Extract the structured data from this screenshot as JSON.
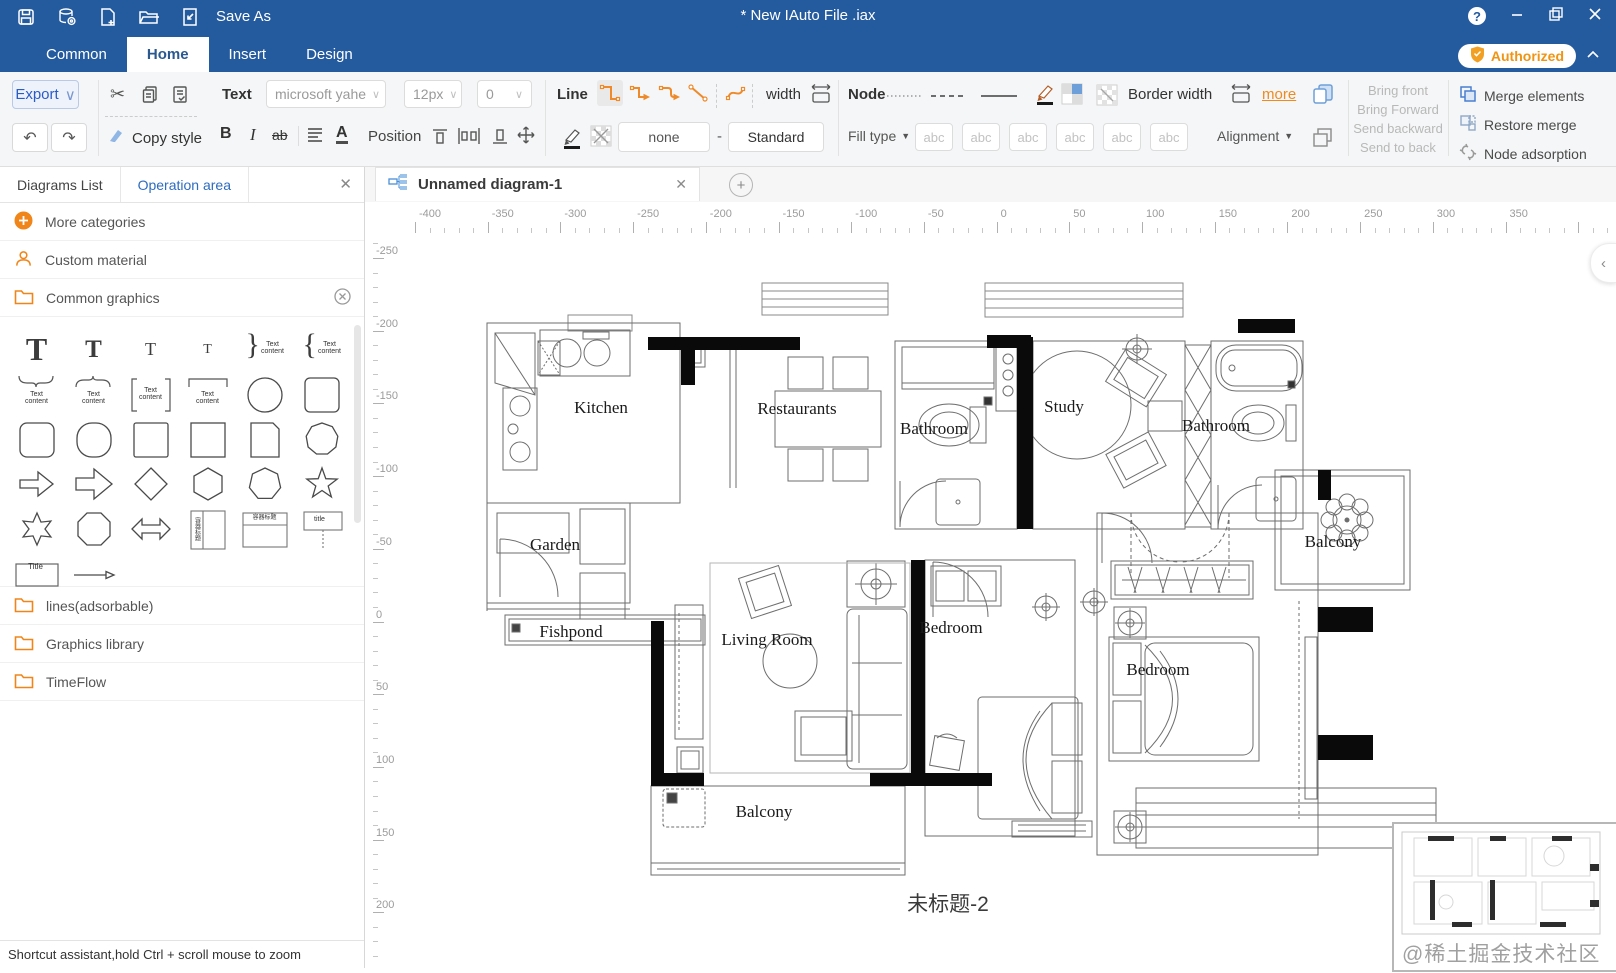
{
  "titlebar": {
    "save_as": "Save As",
    "title": "* New IAuto File .iax",
    "help": "?",
    "authorized": "Authorized"
  },
  "menu": {
    "items": [
      "Common",
      "Home",
      "Insert",
      "Design"
    ],
    "active": "Home"
  },
  "toolbar": {
    "export": "Export",
    "text_label": "Text",
    "font_family": "microsoft yahe",
    "font_size": "12px",
    "char_spacing": "0",
    "copy_style": "Copy style",
    "bold": "B",
    "italic": "I",
    "strikethrough": "ab",
    "font_color": "A",
    "position_label": "Position",
    "line_label": "Line",
    "width_label": "width",
    "line_fill_value": "none",
    "dash": "-",
    "line_style_value": "Standard",
    "node_label": "Node",
    "fill_type_label": "Fill type",
    "abc_sample": "abc",
    "border_width_label": "Border width",
    "more_link": "more",
    "alignment_label": "Alignment",
    "bring_front": "Bring front",
    "bring_forward": "Bring Forward",
    "send_backward": "Send backward",
    "send_to_back": "Send to back",
    "merge_elements": "Merge elements",
    "restore_merge": "Restore merge",
    "node_adsorption": "Node adsorption"
  },
  "sidebar": {
    "tab_diagrams": "Diagrams List",
    "tab_operation": "Operation area",
    "more_categories": "More categories",
    "custom_material": "Custom material",
    "common_graphics": "Common graphics",
    "lines_adsorbable": "lines(adsorbable)",
    "graphics_library": "Graphics library",
    "timeflow": "TimeFlow",
    "palette": {
      "text_content": "Text content",
      "container_title": "容器标题",
      "callout_title": "title",
      "title": "Title"
    },
    "footer": "Shortcut assistant,hold Ctrl + scroll mouse to zoom"
  },
  "canvas": {
    "doc_tab": "Unnamed diagram-1",
    "diagram_title": "未标题-2",
    "watermark": "@稀土掘金技术社区",
    "h_ruler": [
      -400,
      -350,
      -300,
      -250,
      -200,
      -150,
      -100,
      -50,
      0,
      50,
      100,
      150,
      200,
      250,
      300,
      350
    ],
    "v_ruler": [
      -250,
      -200,
      -150,
      -100,
      -50,
      0,
      50,
      100,
      150,
      200
    ]
  },
  "floorplan": {
    "rooms": [
      {
        "label": "Kitchen"
      },
      {
        "label": "Restaurants"
      },
      {
        "label": "Bathroom"
      },
      {
        "label": "Study"
      },
      {
        "label": "Bathroom"
      },
      {
        "label": "Garden"
      },
      {
        "label": "Fishpond"
      },
      {
        "label": "Living Room"
      },
      {
        "label": "Bedroom"
      },
      {
        "label": "Bedroom"
      },
      {
        "label": "Balcony"
      },
      {
        "label": "Balcony"
      }
    ]
  },
  "colors": {
    "titlebar_blue": "#245a9e",
    "accent_orange": "#ef8b1d",
    "accent_blue": "#4a7fd0",
    "export_blue": "#2a5cc8",
    "wall_black": "#0a0a0a"
  }
}
